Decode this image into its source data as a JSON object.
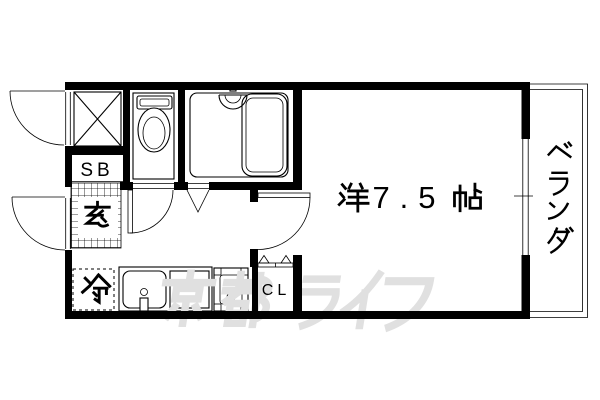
{
  "plan": {
    "labels": {
      "main_room": "洋7.5帖",
      "main_room_size": "7.5",
      "veranda": "ベランダ",
      "entrance": "玄",
      "shoe_box": "SB",
      "closet": "CL",
      "refrigerator": "冷"
    },
    "watermark": {
      "text": "京都ライフ",
      "color": "#e0e0e0"
    },
    "fixtures": {
      "meter_box": "cross-box",
      "toilet": "toilet-with-tank",
      "bathroom": "unit-bath-with-tub-and-shower",
      "kitchen": "sink-counter-stove",
      "closet_door": "folding-door",
      "entrance_doors": "outward-swing-doors",
      "main_room_door": "inward-swing-door",
      "window": "sliding-window"
    },
    "colors": {
      "wall": "#000000",
      "background": "#ffffff",
      "watermark": "#e0e0e0"
    }
  }
}
